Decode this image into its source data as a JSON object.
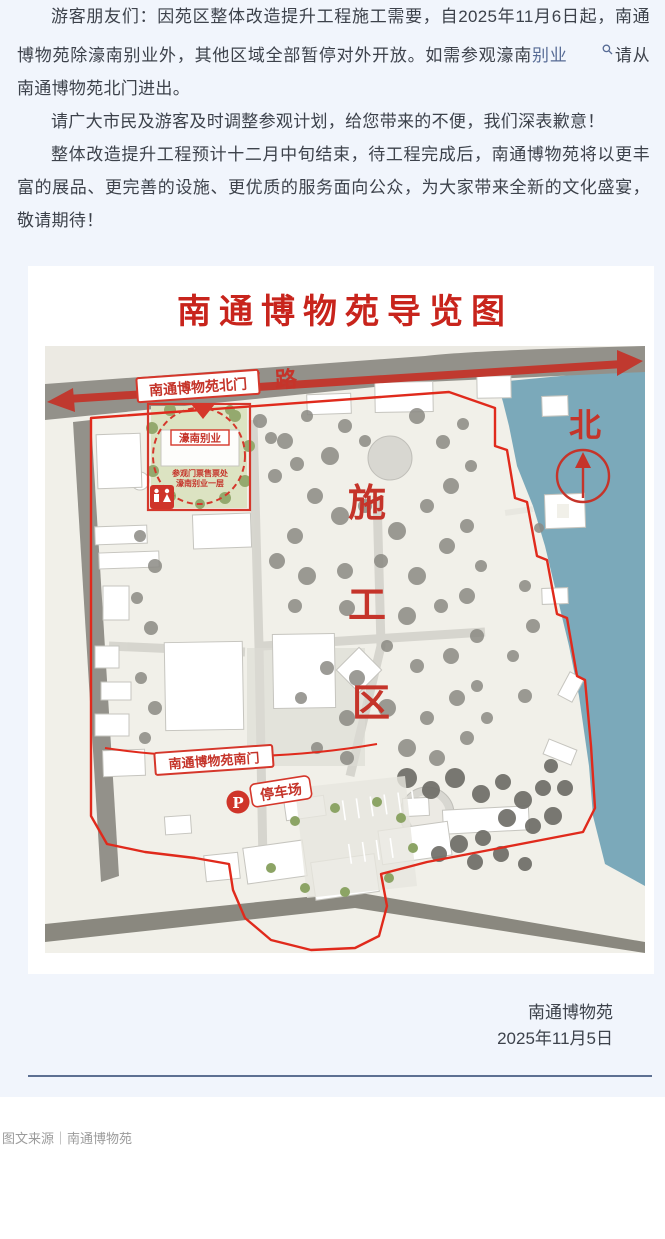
{
  "theme": {
    "page_bg": "#f1f5fc",
    "text_color": "#3d424b",
    "link_color": "#576b95",
    "map_red": "#c8241c",
    "boundary_red": "#e02a1c",
    "water_blue": "#7ba9ba",
    "road_gray": "#93918a",
    "separator_blue": "#5d7092",
    "footer_gray": "#9b9b9b"
  },
  "article": {
    "p1_clipped_first_line": "游客朋友们：因苑区整体改造提升工程施工需要，自2025年11月6日起，南通博",
    "p1_before_link": "物苑除濠南别业外，其他区域全部暂停对外开放。如需参观濠南",
    "p1_link_text": "别业",
    "p1_after_link": "请从南通博物苑北门进出。",
    "p2": "请广大市民及游客及时调整参观计划，给您带来的不便，我们深表歉意！",
    "p3": "整体改造提升工程预计十二月中旬结束，待工程完成后，南通博物苑将以更丰富的展品、更完善的设施、更优质的服务面向公众，为大家带来全新的文化盛宴，敬请期待！"
  },
  "map": {
    "title": "南通博物苑导览图",
    "road_label": "濠南路",
    "north_gate_label": "南通博物苑北门",
    "villa_label": "濠南别业",
    "ticket_line1": "参观门票售票处",
    "ticket_line2": "濠南别业一层",
    "compass_label": "北",
    "construction": [
      "施",
      "工",
      "区"
    ],
    "south_gate_label": "南通博物苑南门",
    "parking_label": "停车场",
    "parking_symbol": "P"
  },
  "signature": {
    "org": "南通博物苑",
    "date": "2025年11月5日"
  },
  "footer": {
    "source": "图文来源｜南通博物苑"
  }
}
